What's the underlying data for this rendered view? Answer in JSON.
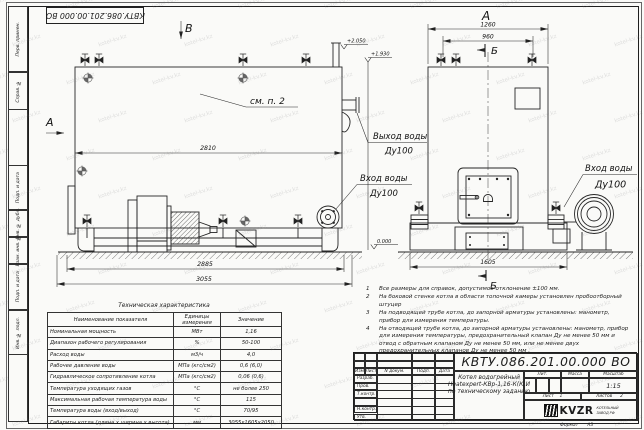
{
  "sheet": {
    "designation_stamp": "КВТУ.086.201.00.000  ВО",
    "format_label": "Формат",
    "format_value": "А3",
    "watermark": "kotel-kv.kz"
  },
  "margin_labels": {
    "perv_primen": "Перв. примен.",
    "sprav_no": "Справ. №",
    "podp_data_1": "Подп. и дата",
    "inv_dubl": "Инв. № дубл.",
    "vzam_inv": "Взам. инв. №",
    "podp_data_2": "Подп. и дата",
    "inv_podl": "Инв. № подл."
  },
  "drawing": {
    "side_view": {
      "view_arrow_b": "В",
      "section_arrow_a": "А",
      "callout": "см. п. 2",
      "dim_length_flange": "2810",
      "dim_length_body": "2885",
      "dim_length_total": "3055",
      "elev_top": "+2.050",
      "elev_outlet": "+1.930",
      "outlet_label": "Выход воды",
      "outlet_dn": "Ду100",
      "inlet_label": "Вход воды",
      "inlet_dn": "Ду100"
    },
    "front_view": {
      "view_label": "А",
      "dim_width_total": "1260",
      "dim_valves": "960",
      "section_b_top": "Б",
      "section_b_bottom": "Б",
      "dim_base": "1605",
      "elev_zero": "0.000",
      "inlet_label": "Вход воды",
      "inlet_dn": "Ду100"
    }
  },
  "notes": {
    "items": [
      {
        "num": "1",
        "text": "Все размеры для справок, допустимое отклонение  ±100 мм."
      },
      {
        "num": "2",
        "text": "На боковой стенке котла в области топочной камеры установлен пробоотборный штуцер"
      },
      {
        "num": "3",
        "text": "На  подводящей трубе котла, до запорной арматуры установлены:  манометр, прибор для измерения температуры."
      },
      {
        "num": "4",
        "text": "На отводящей трубе котла, до запорной арматуры установлены:  манометр, прибор для измерения температуры, предохранительный клапан  Ду не менее 50 мм и отвод с обратным клапаном  Ду не менее 50 мм, или не менее двух предохранительных клапанов  Ду не менее 50 мм ."
      }
    ]
  },
  "spec_table": {
    "title": "Техническая характеристика",
    "headers": [
      "Наименование показателя",
      "Единицы измерения",
      "Значение"
    ],
    "rows": [
      [
        "Номинальная мощность",
        "МВт",
        "1,16"
      ],
      [
        "Диапазон рабочего регулирования",
        "%",
        "50-100"
      ],
      [
        "Расход воды",
        "м3/ч",
        "4,0"
      ],
      [
        "Рабочее давление воды",
        "МПа (кгс/см2)",
        "0,6 (6,0)"
      ],
      [
        "Гидравлическое сопротивление котла",
        "МПа (кгс/см2)",
        "0,06 (0,6)"
      ],
      [
        "Температура уходящих газов",
        "°С",
        "не более 250"
      ],
      [
        "Максимальная рабочая температура воды",
        "°С",
        "115"
      ],
      [
        "Температура воды (вход/выход)",
        "°С",
        "70/95"
      ],
      [
        "Габариты котла (длина х ширина х высота)",
        "мм",
        "3055х1605х2050"
      ]
    ]
  },
  "title_block": {
    "designation": "КВТУ.086.201.00.000  ВО",
    "header": [
      "Изм",
      "Лист",
      "N докум.",
      "Подп.",
      "Дата"
    ],
    "sign_rows": [
      "Разраб.",
      "Пров.",
      "Т.контр.",
      "",
      "Н.контр.",
      "Утв."
    ],
    "name_line1": "Котел водогрейный",
    "name_line2": "Heatexpert-КВр-1,16-К(К)И",
    "name_line3": "по техническому заданию",
    "lit_label": "Лит.",
    "mass_label": "Масса",
    "scale_label": "Масштаб",
    "scale_value": "1:15",
    "sheet_label": "Лист",
    "sheet_value": "1",
    "sheets_label": "Листов",
    "sheets_value": "2",
    "logo_text": "KVZR",
    "company_line1": "КОТЕЛЬНЫЙ",
    "company_line2": "ЗАВОД РФ"
  }
}
